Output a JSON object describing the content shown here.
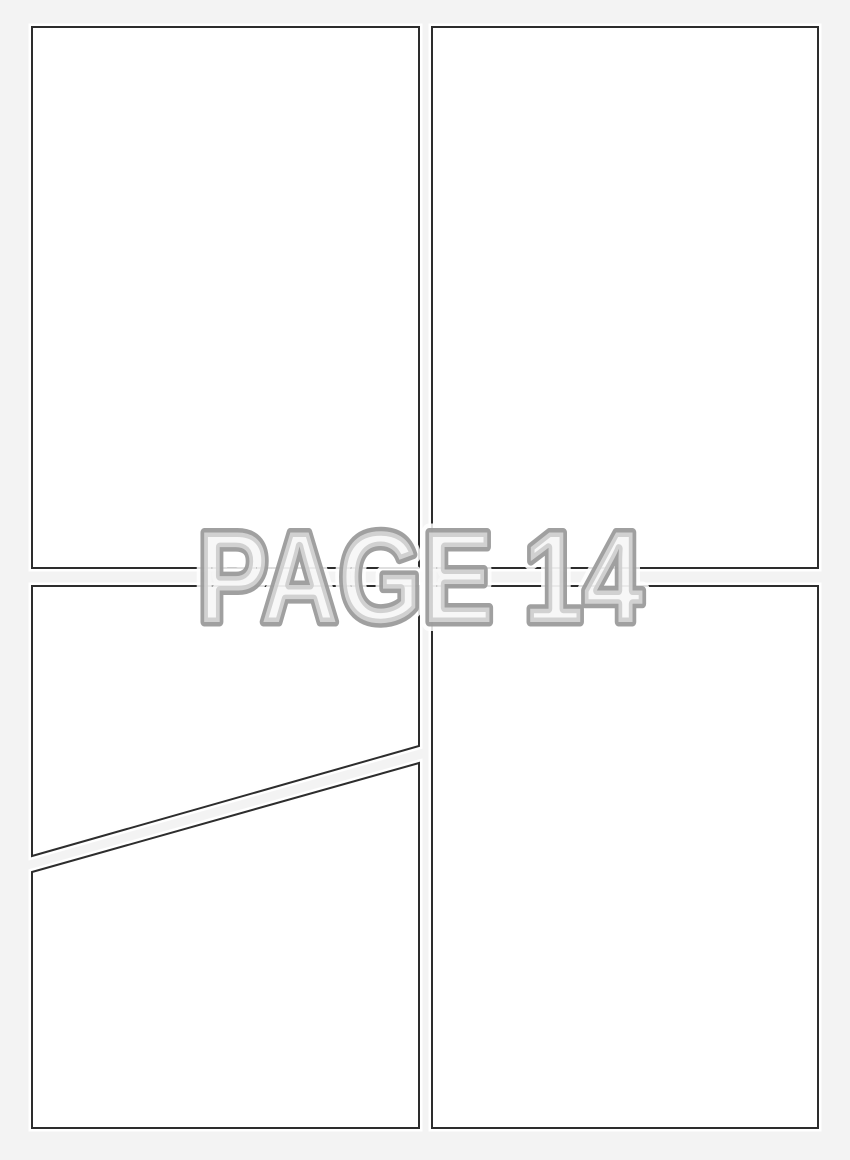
{
  "page": {
    "background_color": "#f3f3f3",
    "panel_fill_color": "#ffffff",
    "panel_border_color": "#2d2d2d",
    "panel_rim_color": "#ffffff",
    "panel_count": 4,
    "sub_panel_count": 5
  },
  "watermark": {
    "label": "PAGE 14",
    "outline_color": "#9b9b9b",
    "halo_color": "#ffffff",
    "fill_color": "#f2f2f2"
  }
}
